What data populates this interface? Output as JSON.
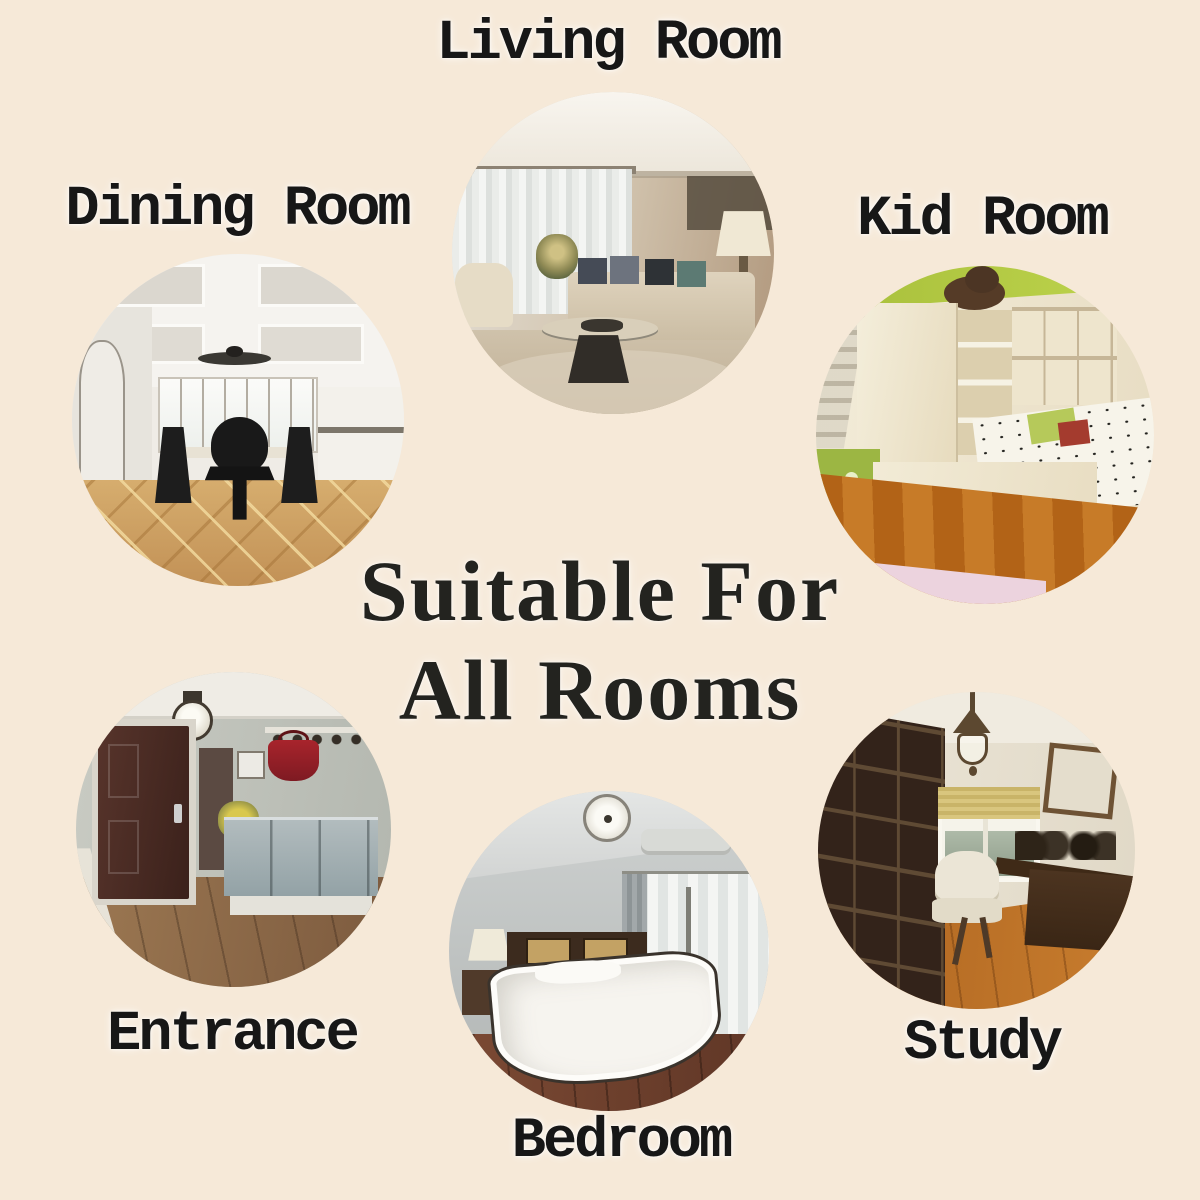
{
  "background_color": "#f6e9d8",
  "label_color": "#171717",
  "title": {
    "line1": "Suitable For",
    "line2": "All Rooms",
    "color": "#23231f"
  },
  "rooms": {
    "living": {
      "label": "Living Room",
      "alt": "Photo of a modern living room with sheer curtains, beige sofa with dark cushions and an oval coffee table"
    },
    "dining": {
      "label": "Dining Room",
      "alt": "Photo of a dining room with coffered white ceiling, ceiling fan, dark upholstered chairs and patterned wood floor"
    },
    "kid": {
      "label": "Kid Room",
      "alt": "Photo of a kid room with lime green accents, cream wardrobe, patterned bed and orange wood floor"
    },
    "entrance": {
      "label": "Entrance",
      "alt": "Photo of an entrance hall with dark wooden door, coat hooks with red bag, grey bench and wood floor"
    },
    "bedroom": {
      "label": "Bedroom",
      "alt": "Photo of a bedroom with grey walls, dark headboard, white duvet with dark trim and window with sheer curtains"
    },
    "study": {
      "label": "Study",
      "alt": "Photo of a study with dark bookshelves, lantern chandelier, window with blind, white chair and wooden desk"
    }
  }
}
